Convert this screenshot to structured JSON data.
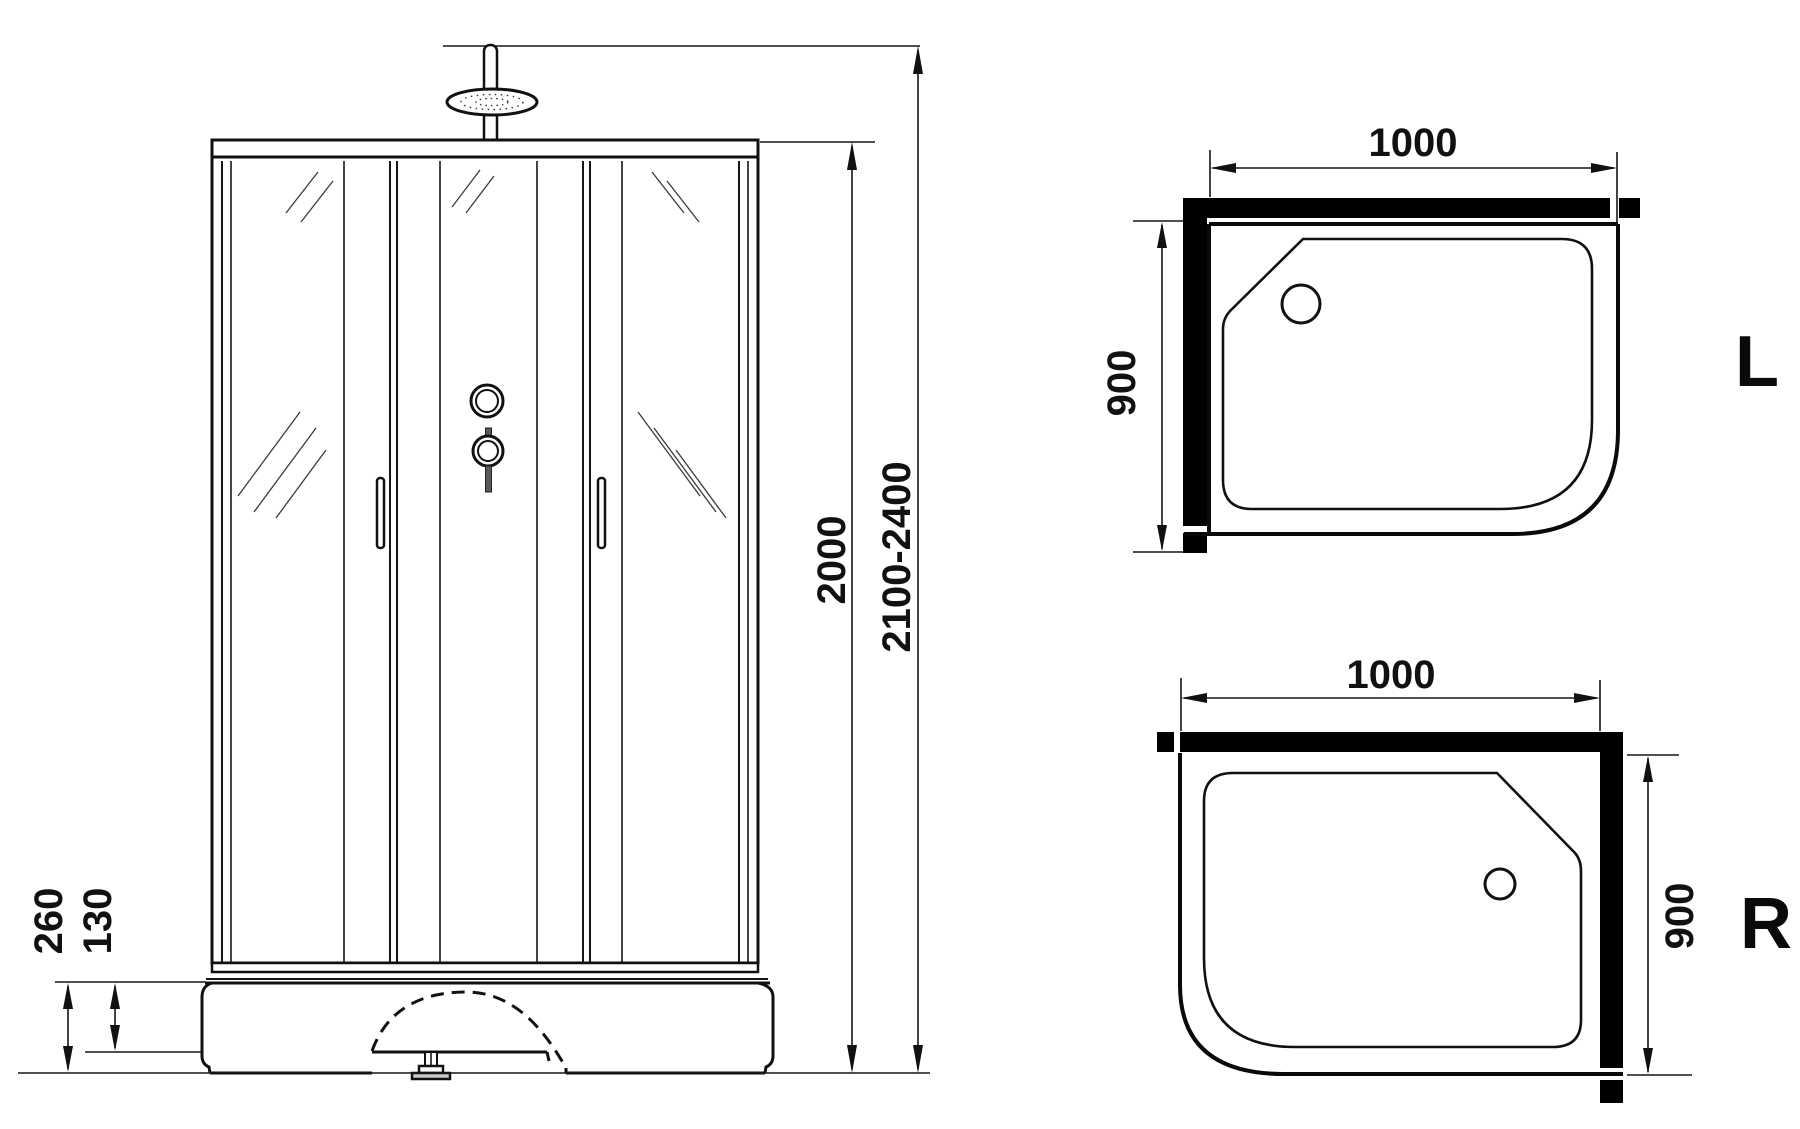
{
  "drawing_title": "shower-cabin-technical-drawing",
  "colors": {
    "background": "#ffffff",
    "line": "#111111",
    "wall_fill": "#000000",
    "foot_fill": "#c9c9c9"
  },
  "front_view": {
    "dim_cabin_height": "2000",
    "dim_total_height": "2100-2400",
    "dim_base_height": "260",
    "dim_tray_height": "130"
  },
  "top_view_left": {
    "label": "L",
    "dim_width": "1000",
    "dim_depth": "900"
  },
  "top_view_right": {
    "label": "R",
    "dim_width": "1000",
    "dim_depth": "900"
  }
}
